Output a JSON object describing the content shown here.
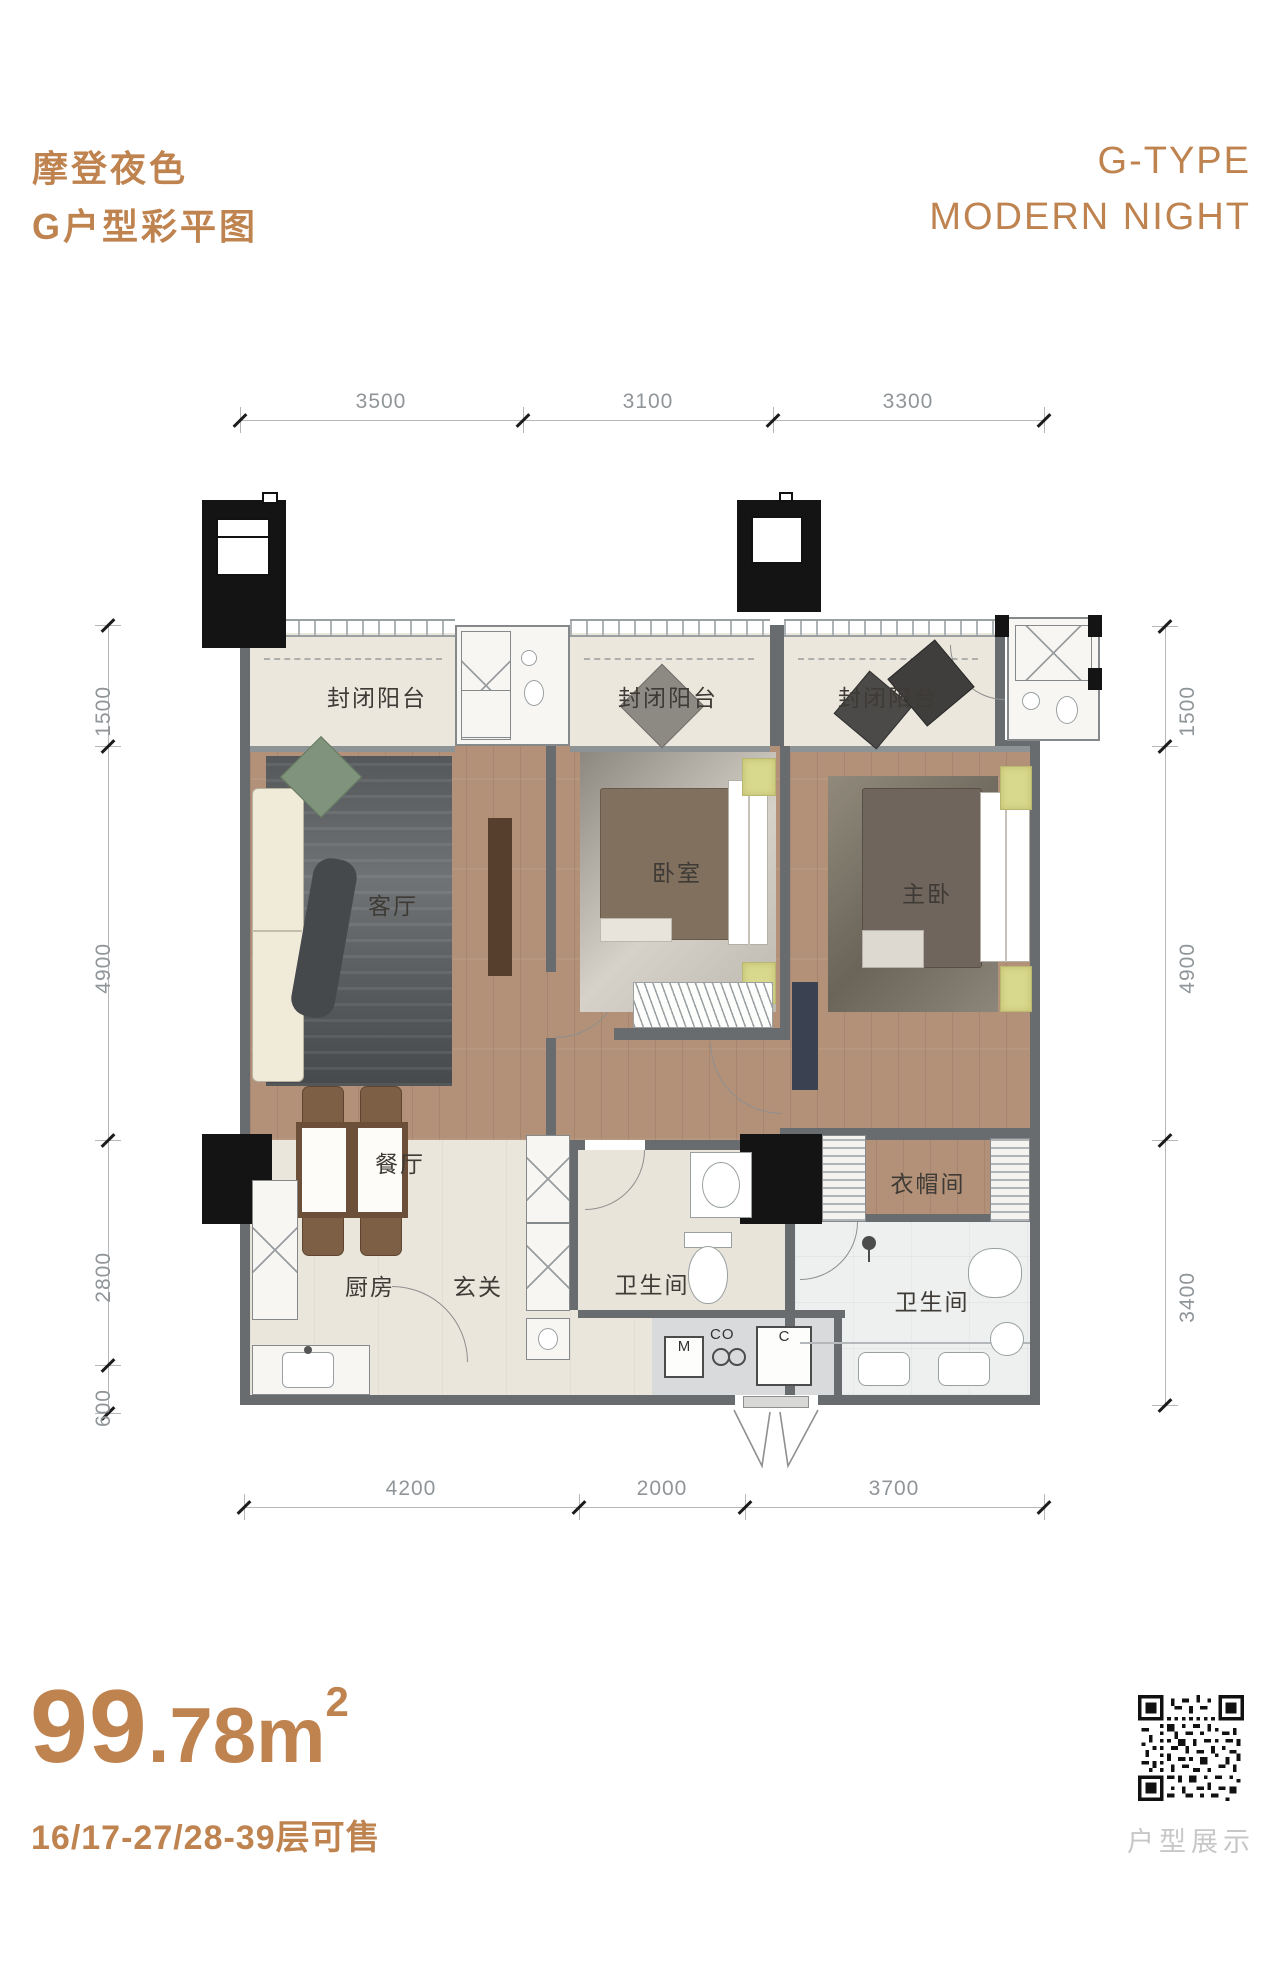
{
  "header": {
    "title_cn": "摩登夜色",
    "subtitle_cn": "G户型彩平图",
    "title_en": "G-TYPE",
    "subtitle_en": "MODERN NIGHT"
  },
  "dimensions": {
    "top": [
      "3500",
      "3100",
      "3300"
    ],
    "bottom": [
      "4200",
      "2000",
      "3700"
    ],
    "left": [
      "1500",
      "4900",
      "2800",
      "600"
    ],
    "right": [
      "1500",
      "4900",
      "3400"
    ]
  },
  "rooms": {
    "balcony_1": "封闭阳台",
    "balcony_2": "封闭阳台",
    "balcony_3": "封闭阳台",
    "living": "客厅",
    "bedroom": "卧室",
    "master": "主卧",
    "dining": "餐厅",
    "kitchen": "厨房",
    "entry": "玄关",
    "bath_1": "卫生间",
    "bath_2": "卫生间",
    "cloakroom": "衣帽间"
  },
  "appliances": {
    "m": "M",
    "co": "CO",
    "c": "C"
  },
  "footer": {
    "area_main": "99",
    "area_rest": ".78m",
    "area_sup": "2",
    "floors": "16/17-27/28-39层可售",
    "qr_caption": "户型展示"
  },
  "colors": {
    "accent": "#BF8350",
    "wall": "#686C6F",
    "wood_floor": "#B29178",
    "tile_floor": "#EAE6DC",
    "marble_floor": "#EEF0F0",
    "dim_text": "#8F9598"
  }
}
